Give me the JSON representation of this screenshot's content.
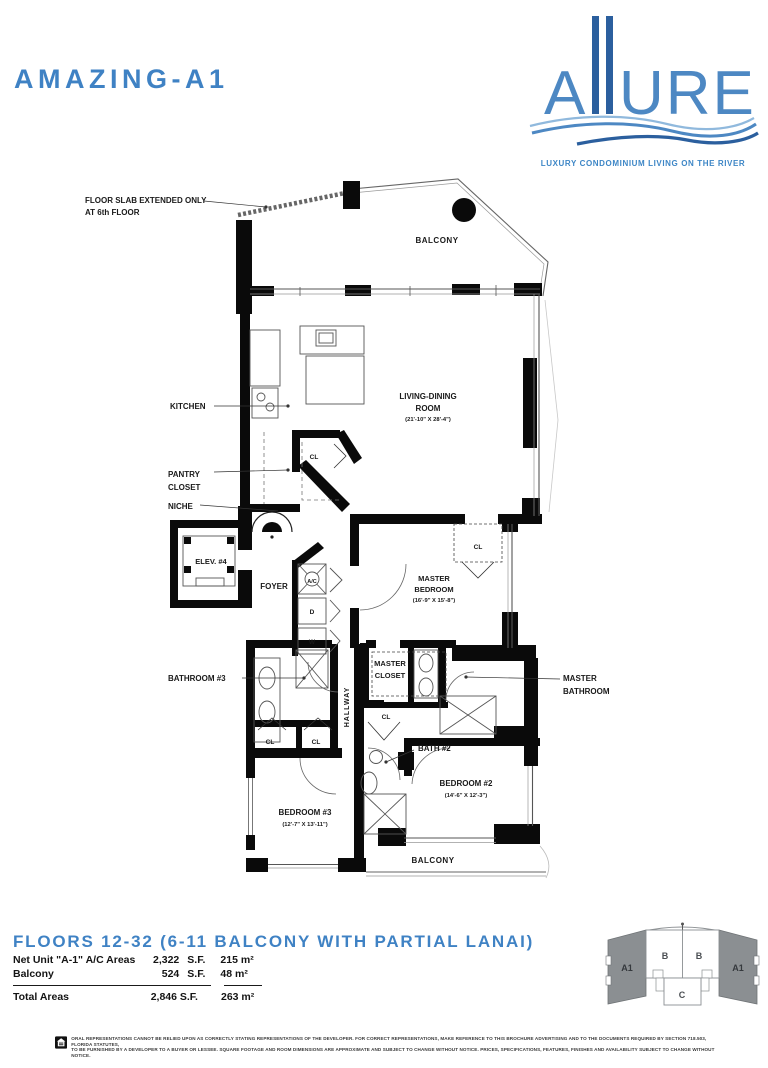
{
  "header": {
    "title": "AMAZING-A1"
  },
  "logo": {
    "word_a": "A",
    "word_ure": "URE",
    "tagline": "LUXURY CONDOMINIUM LIVING ON THE RIVER"
  },
  "plan": {
    "slab_note_line1": "FLOOR SLAB EXTENDED ONLY",
    "slab_note_line2": "AT 6th FLOOR",
    "balcony_top": "BALCONY",
    "kitchen": "KITCHEN",
    "living_line1": "LIVING-DINING",
    "living_line2": "ROOM",
    "living_dim": "(21'-10\" X 28'-4\")",
    "pantry_line1": "PANTRY",
    "pantry_line2": "CLOSET",
    "niche": "NICHE",
    "closet_abbr": "CL",
    "elevator": "ELEV. #4",
    "foyer": "FOYER",
    "ac_unit": "A/C",
    "dryer": "D",
    "washer": "W",
    "master_bed_line1": "MASTER",
    "master_bed_line2": "BEDROOM",
    "master_bed_dim": "(16'-9\" X 15'-8\")",
    "bathroom3": "BATHROOM #3",
    "master_closet_line1": "MASTER",
    "master_closet_line2": "CLOSET",
    "hallway": "HALLWAY",
    "master_bath_line1": "MASTER",
    "master_bath_line2": "BATHROOM",
    "bath2": "BATH #2",
    "bedroom3": "BEDROOM #3",
    "bedroom3_dim": "(12'-7\" X 13'-11\")",
    "bedroom2": "BEDROOM #2",
    "bedroom2_dim": "(14'-6\" X 12'-3\")",
    "balcony_bottom": "BALCONY"
  },
  "footer": {
    "heading": "FLOORS 12-32 (6-11 BALCONY WITH PARTIAL LANAI)",
    "area_table": {
      "rows": [
        {
          "label": "Net Unit \"A-1\" A/C Areas",
          "value": "2,322",
          "unit": "S.F.",
          "metric": "215 m²"
        },
        {
          "label": "Balcony",
          "value": "524",
          "unit": "S.F.",
          "metric": "48 m²"
        }
      ],
      "total": {
        "label": "Total Areas",
        "imperial": "2,846 S.F.",
        "metric": "263 m²"
      }
    },
    "keyplan": {
      "left_a1": "A1",
      "b1": "B",
      "b2": "B",
      "c": "C",
      "right_a1": "A1"
    },
    "disclaimer_line1": "ORAL REPRESENTATIONS CANNOT BE RELIED UPON AS CORRECTLY STATING REPRESENTATIONS OF THE DEVELOPER. FOR CORRECT REPRESENTATIONS, MAKE REFERENCE TO THIS BROCHURE ADVERTISING AND TO THE DOCUMENTS REQUIRED BY SECTION 718.503, FLORIDA STATUTES,",
    "disclaimer_line2": "TO BE FURNISHED BY A DEVELOPER TO A BUYER OR LESSEE. SQUARE FOOTAGE AND ROOM DIMENSIONS ARE APPROXIMATE AND SUBJECT TO CHANGE WITHOUT NOTICE. PRICES, SPECIFICATIONS, FEATURES, FINISHES AND AVAILABILITY SUBJECT TO CHANGE WITHOUT NOTICE."
  },
  "colors": {
    "brand_blue": "#3f82c4",
    "logo_navy": "#2b5f9e",
    "wall_black": "#0a0a0a",
    "keyplan_gray": "#8b8f92"
  }
}
